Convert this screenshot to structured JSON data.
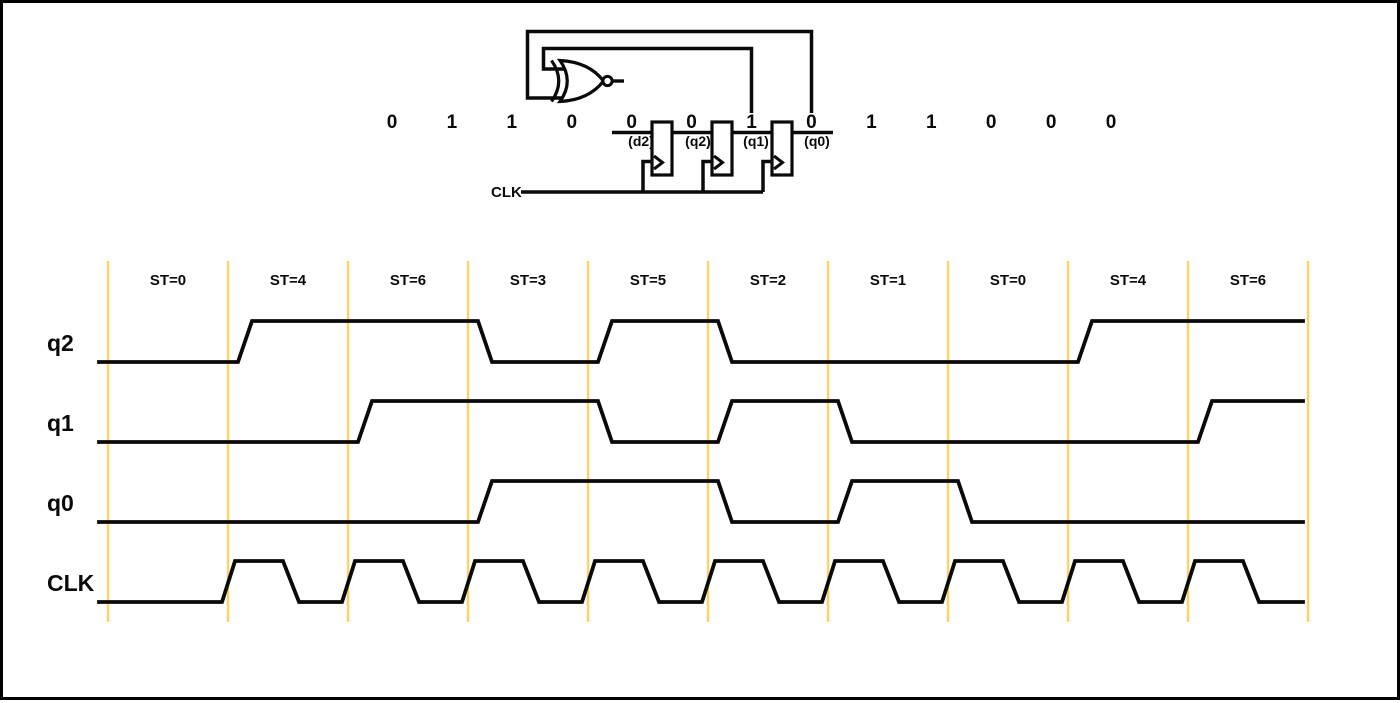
{
  "colors": {
    "background": "#FFFFFF",
    "line": "#0A0A0A",
    "gridline": "#F9D468"
  },
  "circuit": {
    "serial_bits": [
      "0",
      "1",
      "1",
      "0",
      "0",
      "0",
      "1",
      "0",
      "1",
      "1",
      "0",
      "0",
      "0"
    ],
    "register_labels": [
      "(d2)",
      "(q2)",
      "(q1)",
      "(q0)"
    ],
    "clk_label": "CLK",
    "gate_icon": "xnor-gate-icon",
    "flip_flop_count": 3
  },
  "timing": {
    "state_labels": [
      "ST=0",
      "ST=4",
      "ST=6",
      "ST=3",
      "ST=5",
      "ST=2",
      "ST=1",
      "ST=0",
      "ST=4",
      "ST=6"
    ],
    "signals": [
      {
        "name": "q2",
        "type": "data",
        "values": [
          0,
          1,
          1,
          0,
          1,
          0,
          0,
          0,
          1,
          1
        ]
      },
      {
        "name": "q1",
        "type": "data",
        "values": [
          0,
          0,
          1,
          1,
          0,
          1,
          0,
          0,
          0,
          1
        ]
      },
      {
        "name": "q0",
        "type": "data",
        "values": [
          0,
          0,
          0,
          1,
          1,
          0,
          1,
          0,
          0,
          0
        ]
      },
      {
        "name": "CLK",
        "type": "clock",
        "pulse_intervals": [
          2,
          3,
          4,
          5,
          6,
          7,
          8,
          9,
          10
        ]
      }
    ]
  }
}
